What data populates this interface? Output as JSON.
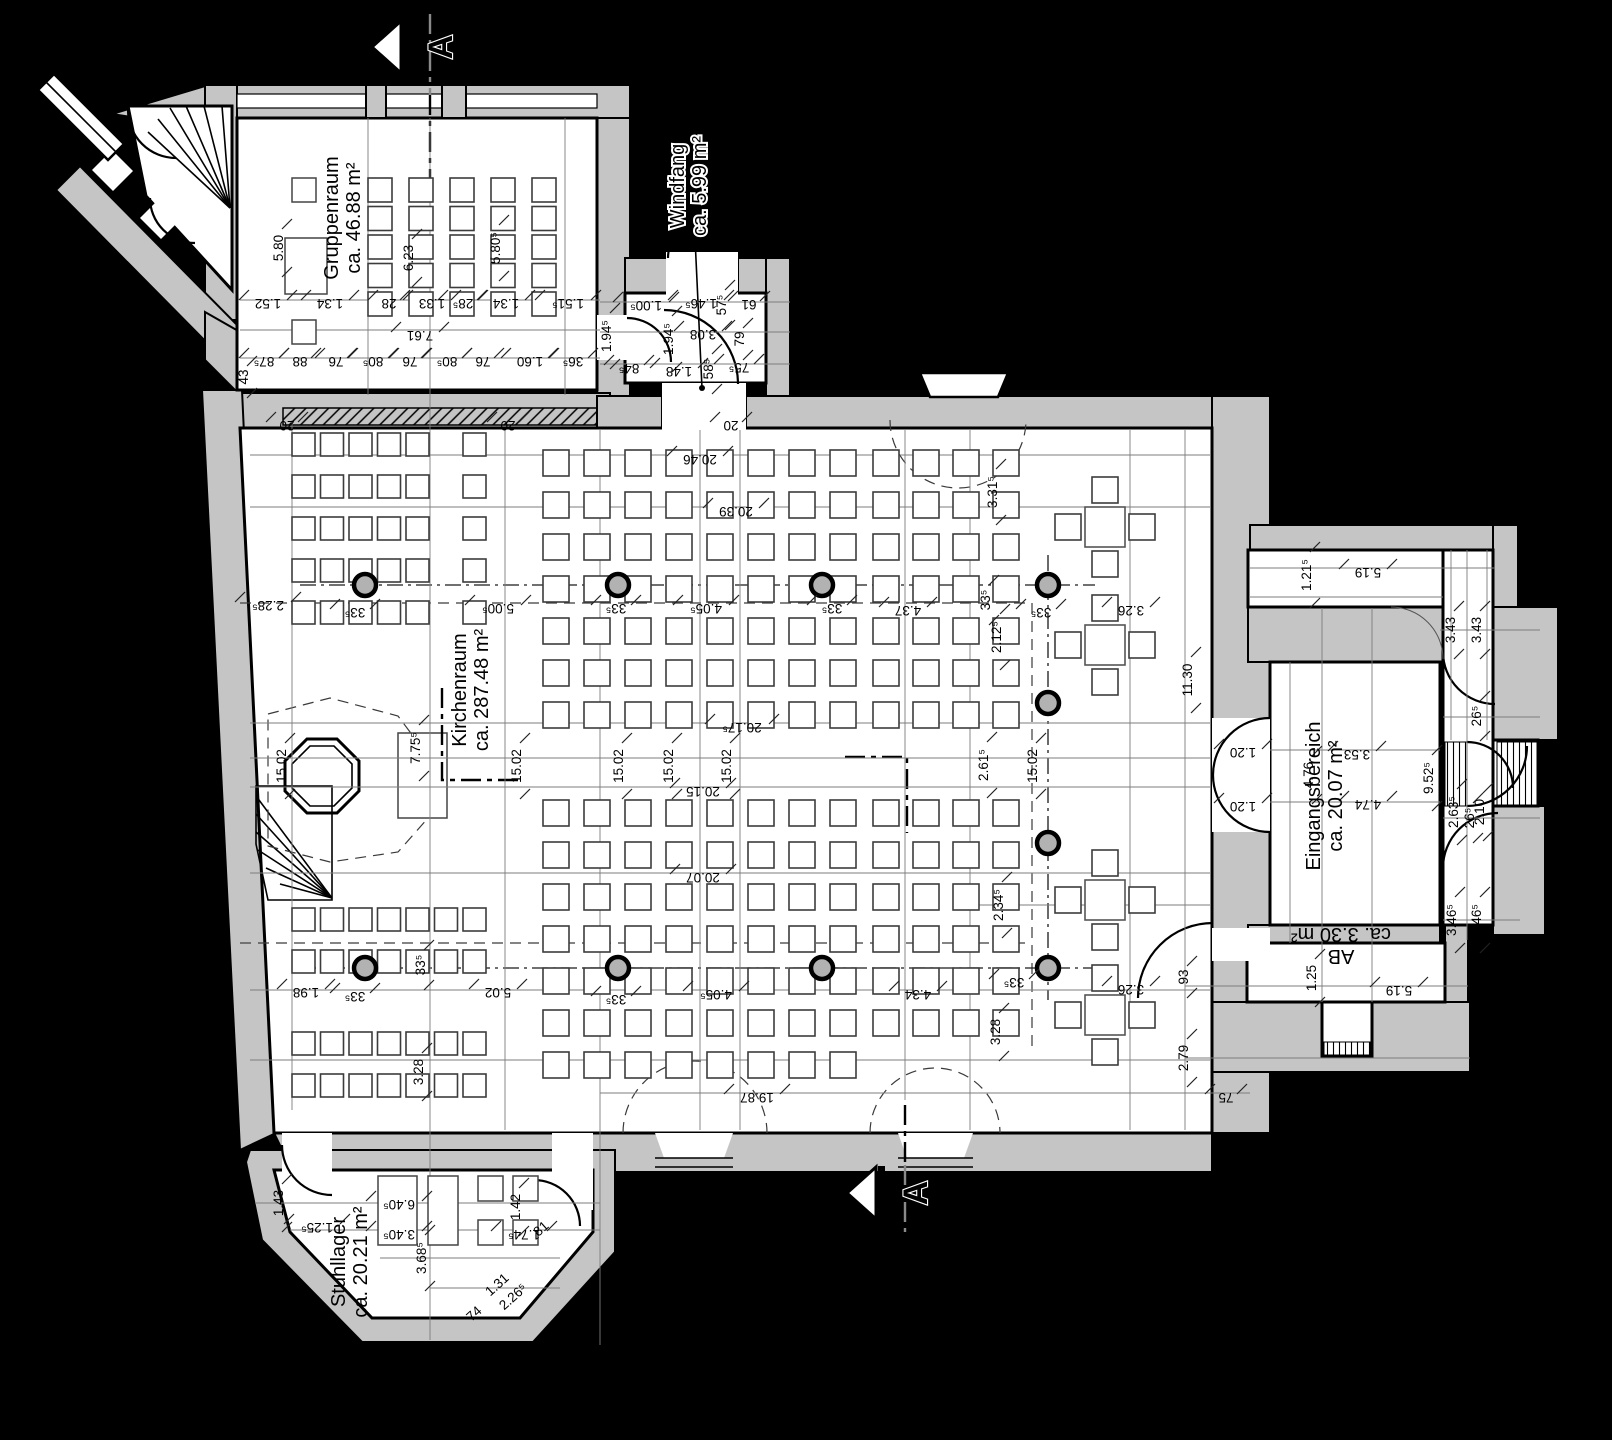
{
  "drawing": {
    "kind": "church-floor-plan",
    "colors": {
      "background": "#000000",
      "wall_fill": "#c5c5c5",
      "room_fill": "#ffffff",
      "line": "#000000",
      "thin_line": "#7d7d7d",
      "furniture_line": "#3c3c3c",
      "column_fill": "#b2b2b2"
    }
  },
  "rooms": [
    {
      "id": "gruppenraum",
      "lines": [
        "Gruppenraum",
        "ca. 46.88 m²"
      ],
      "x": 338,
      "y": 218,
      "r": -90,
      "halo": false
    },
    {
      "id": "windfang",
      "lines": [
        "Windfang",
        "ca. 5.99 m²"
      ],
      "x": 684,
      "y": 186,
      "r": -90,
      "halo": true
    },
    {
      "id": "kirchenraum",
      "lines": [
        "Kirchenraum",
        "ca. 287.48 m²"
      ],
      "x": 466,
      "y": 690,
      "r": -90,
      "halo": false
    },
    {
      "id": "eingangsbereich",
      "lines": [
        "Eingangsbereich",
        "ca. 20.07 m²"
      ],
      "x": 1320,
      "y": 796,
      "r": -90,
      "halo": false
    },
    {
      "id": "ab",
      "lines": [
        "AB",
        "ca. 3.30 m²"
      ],
      "x": 1341,
      "y": 950,
      "r": 180,
      "halo": false
    },
    {
      "id": "stuhllager",
      "lines": [
        "Stuhllager",
        "ca. 20.21 m²"
      ],
      "x": 345,
      "y": 1262,
      "r": -90,
      "halo": false
    }
  ],
  "section_markers": [
    {
      "label": "A",
      "x": 404,
      "y": 47
    },
    {
      "label": "A",
      "x": 879,
      "y": 1193
    }
  ],
  "dims": [
    {
      "t": "5.80",
      "x": 283,
      "y": 248,
      "r": -90
    },
    {
      "t": "6.23",
      "x": 413,
      "y": 258,
      "r": -90
    },
    {
      "t": "5.80⁵",
      "x": 500,
      "y": 248,
      "r": -90
    },
    {
      "t": "1.52",
      "x": 268,
      "y": 299,
      "r": 180
    },
    {
      "t": "1.34",
      "x": 330,
      "y": 299,
      "r": 180
    },
    {
      "t": "28",
      "x": 389,
      "y": 299,
      "r": 180
    },
    {
      "t": "1.33",
      "x": 432,
      "y": 299,
      "r": 180
    },
    {
      "t": "28⁵",
      "x": 463,
      "y": 299,
      "r": 180
    },
    {
      "t": "1.34",
      "x": 506,
      "y": 299,
      "r": 180
    },
    {
      "t": "1.51⁵",
      "x": 568,
      "y": 299,
      "r": 180
    },
    {
      "t": "7.61",
      "x": 420,
      "y": 331,
      "r": 180
    },
    {
      "t": "87⁵",
      "x": 264,
      "y": 357,
      "r": 180
    },
    {
      "t": "88",
      "x": 300,
      "y": 357,
      "r": 180
    },
    {
      "t": "76",
      "x": 336,
      "y": 357,
      "r": 180
    },
    {
      "t": "80⁵",
      "x": 373,
      "y": 357,
      "r": 180
    },
    {
      "t": "76",
      "x": 410,
      "y": 357,
      "r": 180
    },
    {
      "t": "80⁵",
      "x": 447,
      "y": 357,
      "r": 180
    },
    {
      "t": "76",
      "x": 483,
      "y": 357,
      "r": 180
    },
    {
      "t": "1.60",
      "x": 530,
      "y": 357,
      "r": 180
    },
    {
      "t": "36⁵",
      "x": 573,
      "y": 357,
      "r": 180
    },
    {
      "t": "43",
      "x": 248,
      "y": 377,
      "r": -90
    },
    {
      "t": "20",
      "x": 287,
      "y": 421,
      "r": 180
    },
    {
      "t": "20",
      "x": 508,
      "y": 421,
      "r": 180
    },
    {
      "t": "20",
      "x": 731,
      "y": 421,
      "r": 180
    },
    {
      "t": "1.00⁵",
      "x": 646,
      "y": 301,
      "r": 180
    },
    {
      "t": "1.46⁵",
      "x": 701,
      "y": 299,
      "r": 180
    },
    {
      "t": "57⁵",
      "x": 726,
      "y": 305,
      "r": -90
    },
    {
      "t": "61",
      "x": 749,
      "y": 300,
      "r": 180
    },
    {
      "t": "1.94⁵",
      "x": 611,
      "y": 336,
      "r": -90
    },
    {
      "t": "1.94⁵",
      "x": 673,
      "y": 339,
      "r": -90
    },
    {
      "t": "3.08",
      "x": 703,
      "y": 330,
      "r": 180
    },
    {
      "t": "79",
      "x": 744,
      "y": 339,
      "r": -90
    },
    {
      "t": "84⁵",
      "x": 629,
      "y": 364,
      "r": 180
    },
    {
      "t": "1.48",
      "x": 679,
      "y": 367,
      "r": 180
    },
    {
      "t": "58⁵",
      "x": 713,
      "y": 369,
      "r": -90
    },
    {
      "t": "75⁵",
      "x": 739,
      "y": 363,
      "r": 180
    },
    {
      "t": "20.46",
      "x": 700,
      "y": 455,
      "r": 180
    },
    {
      "t": "20.39",
      "x": 736,
      "y": 507,
      "r": 180
    },
    {
      "t": "3.31⁵",
      "x": 997,
      "y": 492,
      "r": -90
    },
    {
      "t": "2.28⁵",
      "x": 268,
      "y": 601,
      "r": 180
    },
    {
      "t": "33⁵",
      "x": 355,
      "y": 608,
      "r": 180
    },
    {
      "t": "5.00⁵",
      "x": 498,
      "y": 604,
      "r": 180
    },
    {
      "t": "33⁵",
      "x": 616,
      "y": 604,
      "r": 180
    },
    {
      "t": "4.05⁵",
      "x": 706,
      "y": 604,
      "r": 180
    },
    {
      "t": "33⁵",
      "x": 832,
      "y": 604,
      "r": 180
    },
    {
      "t": "4.37",
      "x": 908,
      "y": 606,
      "r": 180
    },
    {
      "t": "33⁵",
      "x": 990,
      "y": 600,
      "r": -90
    },
    {
      "t": "33⁵",
      "x": 1041,
      "y": 608,
      "r": 180
    },
    {
      "t": "3.26",
      "x": 1131,
      "y": 606,
      "r": 180
    },
    {
      "t": "2.12⁵",
      "x": 1001,
      "y": 637,
      "r": -90
    },
    {
      "t": "11.30",
      "x": 1192,
      "y": 680,
      "r": -90
    },
    {
      "t": "7.75⁵",
      "x": 420,
      "y": 748,
      "r": -90
    },
    {
      "t": "15.02",
      "x": 286,
      "y": 766,
      "r": -90
    },
    {
      "t": "15.02",
      "x": 521,
      "y": 766,
      "r": -90
    },
    {
      "t": "15.02",
      "x": 623,
      "y": 766,
      "r": -90
    },
    {
      "t": "15.02",
      "x": 673,
      "y": 766,
      "r": -90
    },
    {
      "t": "15.02",
      "x": 731,
      "y": 766,
      "r": -90
    },
    {
      "t": "15.02",
      "x": 1037,
      "y": 766,
      "r": -90
    },
    {
      "t": "20.17⁵",
      "x": 742,
      "y": 723,
      "r": 180
    },
    {
      "t": "20.15",
      "x": 703,
      "y": 787,
      "r": 180
    },
    {
      "t": "2.61⁵",
      "x": 988,
      "y": 765,
      "r": -90
    },
    {
      "t": "20.07",
      "x": 703,
      "y": 873,
      "r": 180
    },
    {
      "t": "2.34⁵",
      "x": 1003,
      "y": 905,
      "r": -90
    },
    {
      "t": "33⁵",
      "x": 1014,
      "y": 978,
      "r": 180
    },
    {
      "t": "3.26",
      "x": 1131,
      "y": 985,
      "r": 180
    },
    {
      "t": "1.98",
      "x": 306,
      "y": 988,
      "r": 180
    },
    {
      "t": "33⁵",
      "x": 355,
      "y": 992,
      "r": 180
    },
    {
      "t": "33⁵",
      "x": 425,
      "y": 965,
      "r": -90
    },
    {
      "t": "5.02",
      "x": 498,
      "y": 988,
      "r": 180
    },
    {
      "t": "33⁵",
      "x": 616,
      "y": 995,
      "r": 180
    },
    {
      "t": "4.05⁵",
      "x": 716,
      "y": 990,
      "r": 180
    },
    {
      "t": "4.34",
      "x": 918,
      "y": 990,
      "r": 180
    },
    {
      "t": "3.28",
      "x": 423,
      "y": 1072,
      "r": -90
    },
    {
      "t": "3.28",
      "x": 1000,
      "y": 1032,
      "r": -90
    },
    {
      "t": "19.87",
      "x": 757,
      "y": 1093,
      "r": 180
    },
    {
      "t": "1.21⁵",
      "x": 1311,
      "y": 575,
      "r": -90
    },
    {
      "t": "5.19",
      "x": 1368,
      "y": 568,
      "r": 180
    },
    {
      "t": "3.43",
      "x": 1455,
      "y": 630,
      "r": -90
    },
    {
      "t": "3.43",
      "x": 1481,
      "y": 630,
      "r": -90
    },
    {
      "t": "1.20",
      "x": 1243,
      "y": 748,
      "r": 180
    },
    {
      "t": "1.20",
      "x": 1243,
      "y": 802,
      "r": 180
    },
    {
      "t": "4.76",
      "x": 1313,
      "y": 775,
      "r": -90
    },
    {
      "t": "3.53",
      "x": 1357,
      "y": 750,
      "r": 180
    },
    {
      "t": "4.74",
      "x": 1368,
      "y": 800,
      "r": 180
    },
    {
      "t": "9.52⁵",
      "x": 1433,
      "y": 778,
      "r": -90
    },
    {
      "t": "2.63⁵",
      "x": 1458,
      "y": 812,
      "r": -90
    },
    {
      "t": "2.10",
      "x": 1484,
      "y": 812,
      "r": -90
    },
    {
      "t": "26⁵",
      "x": 1481,
      "y": 716,
      "r": -90
    },
    {
      "t": "26⁵",
      "x": 1474,
      "y": 818,
      "r": -90
    },
    {
      "t": "3.46⁵",
      "x": 1456,
      "y": 920,
      "r": -90
    },
    {
      "t": "3.46⁵",
      "x": 1481,
      "y": 920,
      "r": -90
    },
    {
      "t": "93",
      "x": 1188,
      "y": 977,
      "r": -90
    },
    {
      "t": "1.25",
      "x": 1316,
      "y": 978,
      "r": -90
    },
    {
      "t": "5.19",
      "x": 1399,
      "y": 986,
      "r": 180
    },
    {
      "t": "2.79",
      "x": 1188,
      "y": 1058,
      "r": -90
    },
    {
      "t": "75",
      "x": 1226,
      "y": 1093,
      "r": 180
    },
    {
      "t": "1.43",
      "x": 283,
      "y": 1203,
      "r": -90
    },
    {
      "t": "1.25⁵",
      "x": 317,
      "y": 1223,
      "r": 180
    },
    {
      "t": "69",
      "x": 252,
      "y": 1247,
      "r": -42
    },
    {
      "t": "1.29",
      "x": 272,
      "y": 1287,
      "r": -42
    },
    {
      "t": "60",
      "x": 286,
      "y": 1330,
      "r": -42
    },
    {
      "t": "2.26⁵",
      "x": 240,
      "y": 1320,
      "r": -42
    },
    {
      "t": "6.40⁵",
      "x": 399,
      "y": 1200,
      "r": 180
    },
    {
      "t": "3.40⁵",
      "x": 399,
      "y": 1230,
      "r": 180
    },
    {
      "t": "3.68⁵",
      "x": 426,
      "y": 1258,
      "r": -90
    },
    {
      "t": "1.42",
      "x": 520,
      "y": 1207,
      "r": -90
    },
    {
      "t": "1.74⁵",
      "x": 524,
      "y": 1230,
      "r": 180
    },
    {
      "t": "81",
      "x": 544,
      "y": 1232,
      "r": -42
    },
    {
      "t": "1.31",
      "x": 500,
      "y": 1288,
      "r": -42
    },
    {
      "t": "74",
      "x": 477,
      "y": 1317,
      "r": -42
    },
    {
      "t": "2.26⁵",
      "x": 516,
      "y": 1300,
      "r": -42
    }
  ],
  "furniture": {
    "chair_blocks": [
      {
        "x": 292,
        "y": 433,
        "cols": 5,
        "rows": 5,
        "dx": 28.5,
        "dy": 42,
        "s": 23
      },
      {
        "x": 463,
        "y": 433,
        "cols": 1,
        "rows": 5,
        "dx": 28.5,
        "dy": 42,
        "s": 23
      },
      {
        "x": 292,
        "y": 908,
        "cols": 7,
        "rows": 2,
        "dx": 28.5,
        "dy": 42,
        "s": 23
      },
      {
        "x": 292,
        "y": 1032,
        "cols": 7,
        "rows": 2,
        "dx": 28.5,
        "dy": 42,
        "s": 23
      },
      {
        "x": 543,
        "y": 450,
        "cols": 8,
        "rows": 7,
        "dx": 41,
        "dy": 42,
        "s": 26
      },
      {
        "x": 873,
        "y": 450,
        "cols": 4,
        "rows": 7,
        "dx": 40,
        "dy": 42,
        "s": 26
      },
      {
        "x": 543,
        "y": 800,
        "cols": 8,
        "rows": 7,
        "dx": 41,
        "dy": 42,
        "s": 26
      },
      {
        "x": 873,
        "y": 800,
        "cols": 4,
        "rows": 6,
        "dx": 40,
        "dy": 42,
        "s": 26
      },
      {
        "x": 368,
        "y": 178,
        "cols": 5,
        "rows": 5,
        "dx": 41,
        "dy": 28.5,
        "s": 24
      }
    ],
    "columns": [
      [
        365,
        585
      ],
      [
        618,
        585
      ],
      [
        822,
        585
      ],
      [
        1048,
        585
      ],
      [
        365,
        968
      ],
      [
        618,
        968
      ],
      [
        822,
        968
      ],
      [
        1048,
        968
      ],
      [
        1048,
        703
      ],
      [
        1048,
        843
      ]
    ],
    "tables": [
      [
        1105,
        527
      ],
      [
        1105,
        645
      ],
      [
        1105,
        900
      ],
      [
        1105,
        1015
      ]
    ],
    "extra_rects": [
      [
        292,
        178,
        24,
        24
      ],
      [
        285,
        238,
        42,
        56
      ],
      [
        292,
        320,
        24,
        24
      ],
      [
        378,
        1176,
        39,
        69
      ],
      [
        428,
        1176,
        30,
        69
      ],
      [
        478,
        1176,
        25,
        25
      ],
      [
        478,
        1220,
        25,
        25
      ],
      [
        513,
        1176,
        25,
        25
      ],
      [
        513,
        1220,
        25,
        25
      ]
    ]
  }
}
